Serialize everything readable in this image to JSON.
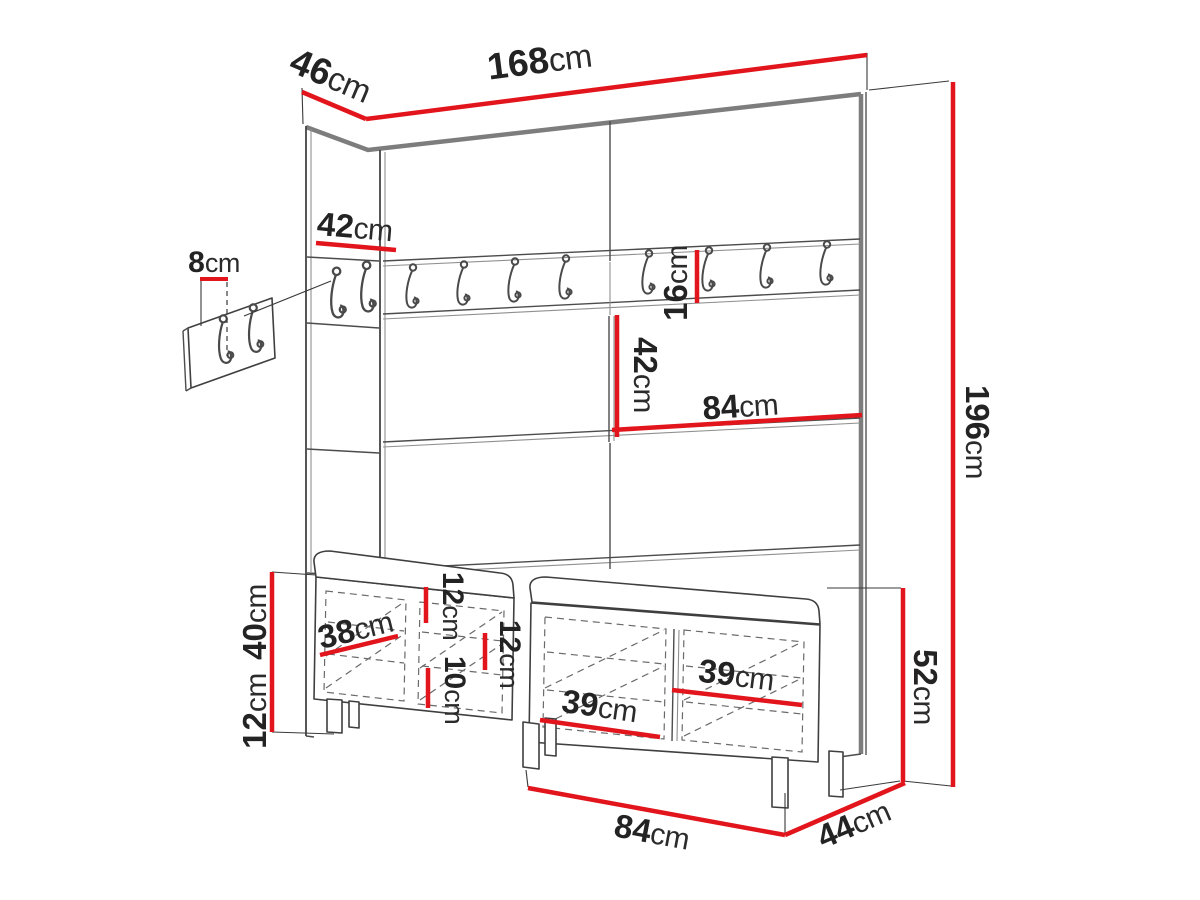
{
  "diagram": {
    "type": "furniture-dimension-drawing",
    "subject": "hallway wardrobe wall panel set with coat hook rail, hook detail panel and shoe bench with cushions",
    "unit": "cm",
    "accent_color": "#e2151c",
    "line_color": "#4c4c4c",
    "background_color": "#ffffff",
    "hook_count_main_rail": 8,
    "hook_count_side_panel": 2,
    "hook_count_detail_panel": 2
  },
  "dims": {
    "side_depth": {
      "value": "46",
      "unit": "cm"
    },
    "total_width": {
      "value": "168",
      "unit": "cm"
    },
    "side_panel_width": {
      "value": "42",
      "unit": "cm"
    },
    "hook_offset": {
      "value": "8",
      "unit": "cm"
    },
    "rail_height": {
      "value": "16",
      "unit": "cm"
    },
    "mid_panel_height": {
      "value": "42",
      "unit": "cm"
    },
    "mid_panel_width": {
      "value": "84",
      "unit": "cm"
    },
    "total_height": {
      "value": "196",
      "unit": "cm"
    },
    "door_width": {
      "value": "38",
      "unit": "cm"
    },
    "bench_body_height": {
      "value": "40",
      "unit": "cm"
    },
    "bench_leg_height": {
      "value": "12",
      "unit": "cm"
    },
    "shelf_gap_top": {
      "value": "12",
      "unit": "cm"
    },
    "shelf_gap_bottom": {
      "value": "10",
      "unit": "cm"
    },
    "shelf_gap_mid": {
      "value": "12",
      "unit": "cm"
    },
    "shelf_depth_right": {
      "value": "39",
      "unit": "cm"
    },
    "shelf_depth_left": {
      "value": "39",
      "unit": "cm"
    },
    "bench_height_total": {
      "value": "52",
      "unit": "cm"
    },
    "bench_width": {
      "value": "84",
      "unit": "cm"
    },
    "bench_depth": {
      "value": "44",
      "unit": "cm"
    }
  }
}
